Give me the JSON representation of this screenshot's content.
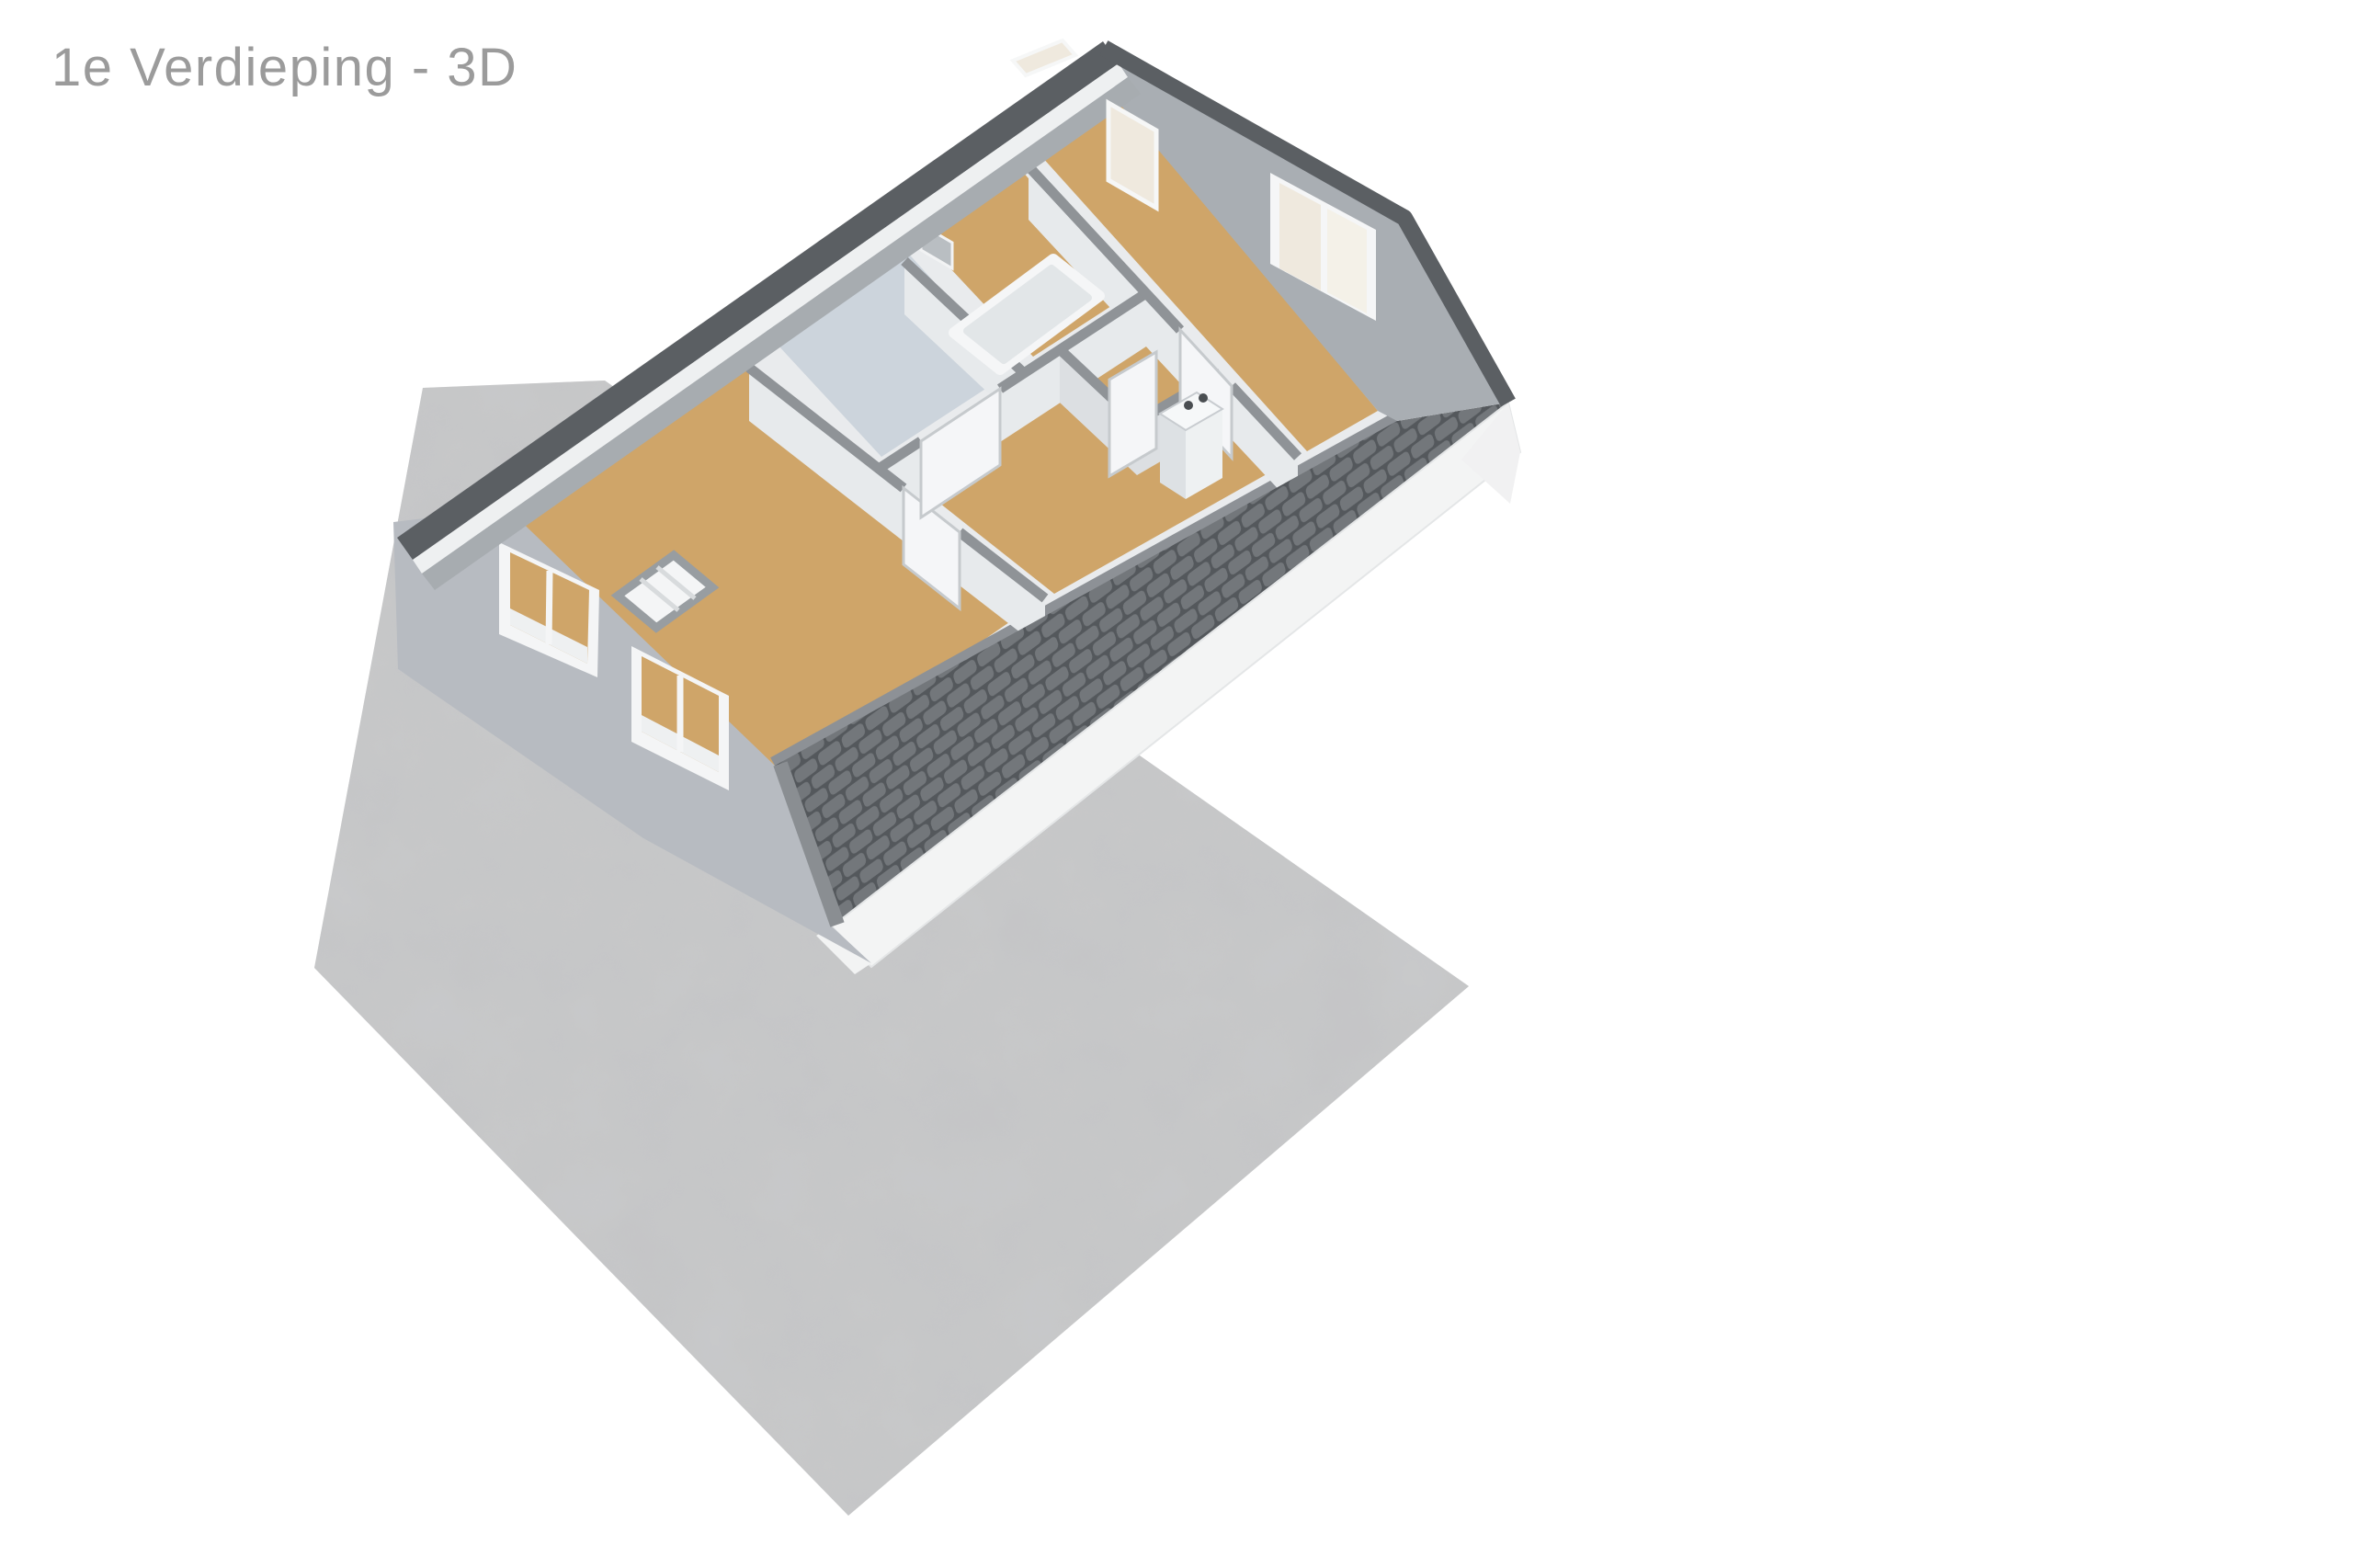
{
  "title": {
    "text": "1e Verdieping - 3D",
    "color": "#9b9b9b"
  },
  "scene": {
    "description": "3D cutaway floor plan of the first floor of a house standing on a concrete slab",
    "floor_label": "1e Verdieping",
    "view_mode": "3D",
    "colors": {
      "background": "#ffffff",
      "ground": "#c8c9ca",
      "roof_edge": "#5b5f63",
      "roof_tile": "#73777b",
      "roof_tile_gap": "#54585c",
      "fascia": "#f3f4f4",
      "exterior_wall": "#b7bbc1",
      "gable_inner_wall": "#a9aeb3",
      "interior_wall_face": "#e7eaec",
      "wall_cap": "#8f9397",
      "floor_wood": "#cfa569",
      "bathroom_floor": "#ccd4dc",
      "fixture": "#f4f5f6",
      "glass_cream": "#efe9de",
      "glass_cream_light": "#f4f1e8",
      "mirror": "#b9bec2",
      "appliance_knob": "#4a4e52"
    }
  }
}
